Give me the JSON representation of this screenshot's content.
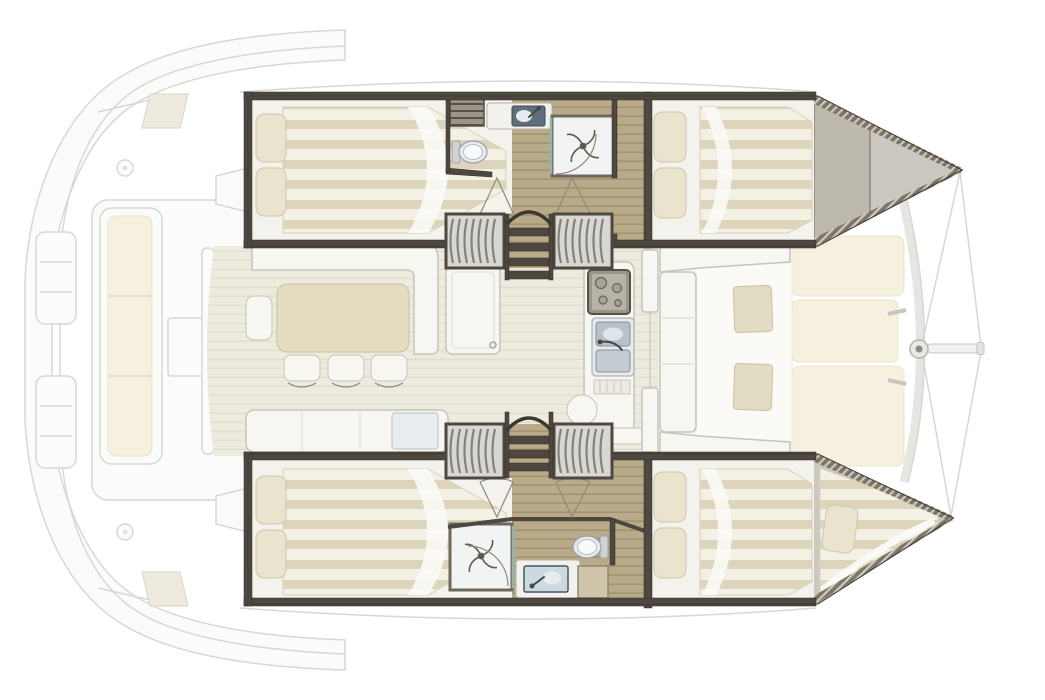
{
  "document": {
    "type": "catamaran-deck-plan",
    "title": "Catamaran interior layout plan, top view, bow to the right",
    "orientation": "bow-right"
  },
  "palette": {
    "wall": "#4e4840",
    "wood": "#b9ab8a",
    "wood_line": "#a2946f",
    "salon_floor": "#edebde",
    "salon_floor_line": "#e1ded1",
    "mattress": "#f3f0e4",
    "mattress_stripe": "#ddd5bb",
    "pillow": "#eae3cd",
    "white_furniture": "#f7f6f1",
    "furniture_line": "#c6c3ba",
    "table": "#e5ddc2",
    "cushion": "#e3dcc4",
    "faded_line": "#d8d7d3",
    "faded_fill": "#fbfbfa",
    "faded_cushion": "#f6f0de",
    "bow_deck": "#cbc8c0",
    "glass": "#8fb8ac",
    "stair_fill": "#d8d7d3",
    "stair_tread": "#85827b",
    "basin": "#b8c1c8"
  },
  "areas": {
    "aft_cockpit": "aft cockpit with bench sofa and table (faded)",
    "salon": "salon with L-shaped sofa, dining table, three stools and chaise longue",
    "galley": "galley island with 4-burner stove, double sink and drainboard",
    "forward_cockpit": "forward cockpit lounge with two side tables",
    "foredeck": "foredeck sunpads, mast and bowsprit (faded)",
    "port_hull": "upper hull: aft double cabin, bathroom with toilet/vanity/shower, companionway stairs, forward double cabin",
    "starboard_hull": "lower hull: aft double cabin, companionway stairs, bathroom with shower/vanity/toilet, forward double cabin, forepeak berth"
  },
  "fixtures": {
    "double_beds": 4,
    "forepeak_berths": 1,
    "toilets": 2,
    "showers": 2,
    "bathroom_vanities": 2,
    "galley_sinks": 2,
    "stove_burners": 4,
    "companionway_stairs": 2,
    "dining_stools": 3,
    "forward_cockpit_tables": 2,
    "foredeck_sunpads": 3,
    "mast": 1,
    "bowsprit": 1
  }
}
